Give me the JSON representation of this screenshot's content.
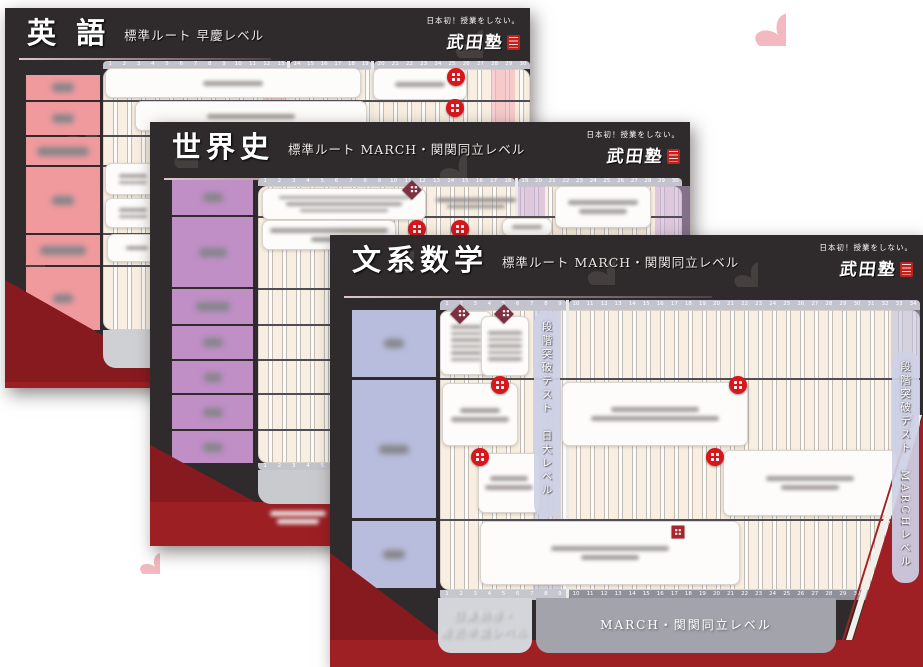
{
  "brand": {
    "tagline": "日本初！授業をしない。",
    "name": "武田塾"
  },
  "page_flowers": [
    [
      130,
      6,
      30
    ],
    [
      752,
      12,
      34
    ],
    [
      3,
      108,
      24
    ],
    [
      5,
      222,
      24
    ],
    [
      138,
      552,
      22
    ]
  ],
  "cards": [
    {
      "id": "english",
      "title": "英 語",
      "subtitle": "標準ルート 早慶レベル",
      "geom": {
        "left": 5,
        "top": 8,
        "width": 525,
        "height": 380
      },
      "colors": {
        "label": "#f09a9e",
        "band": "rgba(244,178,184,0.6)"
      },
      "underline": {
        "y": 50,
        "w": 252
      },
      "flowers": [
        [
          52,
          106,
          40
        ],
        [
          448,
          20,
          30
        ],
        [
          18,
          240,
          22
        ]
      ],
      "labels": {
        "x": 21,
        "y": 67,
        "w": 74,
        "gap": 2,
        "rows": [
          {
            "h": 25,
            "blob": 22
          },
          {
            "h": 33,
            "blob": 22
          },
          {
            "h": 28,
            "blob": 52
          },
          {
            "h": 66,
            "blob": 22
          },
          {
            "h": 30,
            "blob": 46
          },
          {
            "h": 63,
            "blob": 20
          }
        ]
      },
      "grid": {
        "x": 98,
        "y": 53,
        "w": 427,
        "h": 276,
        "strip_h": 8,
        "bottom_strip_h": 7,
        "segments": [
          {
            "x": 98,
            "w": 185,
            "from": 1,
            "to": 13
          },
          {
            "x": 285,
            "w": 82,
            "from": 14,
            "to": 19
          },
          {
            "x": 369,
            "w": 156,
            "from": 20,
            "to": 30
          }
        ],
        "bands": [
          [
            258,
            22
          ],
          [
            486,
            24
          ]
        ],
        "dividers": [
          92,
          127,
          157,
          225,
          257
        ],
        "boxes": [
          {
            "x": 100,
            "y": 60,
            "w": 256,
            "h": 30,
            "lines": [
              60
            ]
          },
          {
            "x": 368,
            "y": 60,
            "w": 94,
            "h": 32,
            "lines": [
              50
            ]
          },
          {
            "x": 130,
            "y": 93,
            "w": 232,
            "h": 30,
            "lines": [
              88
            ]
          },
          {
            "x": 100,
            "y": 155,
            "w": 55,
            "h": 32,
            "small": true,
            "lines": [
              28,
              28
            ]
          },
          {
            "x": 100,
            "y": 190,
            "w": 55,
            "h": 30,
            "small": true,
            "lines": [
              28,
              28
            ]
          },
          {
            "x": 102,
            "y": 226,
            "w": 60,
            "h": 28,
            "small": true,
            "lines": [
              22
            ]
          }
        ],
        "badges": [
          {
            "t": "c",
            "x": 451,
            "y": 69
          },
          {
            "t": "c",
            "x": 450,
            "y": 100
          }
        ]
      },
      "footer": {
        "bars": [
          {
            "x": 98,
            "y": 322,
            "w": 256,
            "h": 38,
            "color": "#cfd0d4",
            "lines": [
              70,
              96
            ]
          }
        ]
      },
      "ribbon": [
        {
          "pts": "0,272 180,374 525,374 525,380 0,380",
          "fill": "#9c1f24"
        },
        {
          "pts": "0,272 180,374 0,374",
          "fill": "#871a1f"
        }
      ]
    },
    {
      "id": "world-history",
      "title": "世界史",
      "subtitle": "標準ルート MARCH・関関同立レベル",
      "geom": {
        "left": 150,
        "top": 122,
        "width": 540,
        "height": 424
      },
      "colors": {
        "label": "#bf8fc5",
        "band": "rgba(200,172,216,0.55)"
      },
      "underline": {
        "y": 56,
        "w": 366
      },
      "flowers": [
        [
          22,
          20,
          26
        ],
        [
          287,
          30,
          30
        ]
      ],
      "labels": {
        "x": 22,
        "y": 58,
        "w": 81,
        "gap": 2,
        "rows": [
          {
            "h": 35,
            "blob": 20
          },
          {
            "h": 70,
            "blob": 28
          },
          {
            "h": 35,
            "blob": 34
          },
          {
            "h": 33,
            "blob": 20
          },
          {
            "h": 32,
            "blob": 18
          },
          {
            "h": 34,
            "blob": 20
          },
          {
            "h": 32,
            "blob": 20
          }
        ]
      },
      "grid": {
        "x": 108,
        "y": 56,
        "w": 424,
        "h": 292,
        "strip_h": 8,
        "bottom_strip_h": 7,
        "segments": [
          {
            "x": 108,
            "w": 257,
            "from": 1,
            "to": 18
          },
          {
            "x": 368,
            "w": 164,
            "from": 19,
            "to": 30
          }
        ],
        "bands": [
          [
            365,
            30
          ],
          [
            505,
            35
          ]
        ],
        "dividers": [
          94,
          166,
          202,
          237,
          271,
          307
        ],
        "boxes": [
          {
            "x": 112,
            "y": 66,
            "w": 164,
            "h": 32,
            "small": true,
            "lines": [
              130,
              116,
              88
            ]
          },
          {
            "x": 280,
            "y": 70,
            "w": 92,
            "h": 22,
            "bare": true,
            "small": true,
            "lines": [
              80,
              58
            ]
          },
          {
            "x": 112,
            "y": 98,
            "w": 134,
            "h": 30,
            "lines": [
              118,
              36
            ]
          },
          {
            "x": 352,
            "y": 96,
            "w": 50,
            "h": 18,
            "small": true,
            "lines": [
              30
            ]
          },
          {
            "x": 405,
            "y": 64,
            "w": 96,
            "h": 42,
            "lines": [
              70,
              48
            ]
          }
        ],
        "badges": [
          {
            "t": "d",
            "x": 262,
            "y": 68
          },
          {
            "t": "c",
            "x": 267,
            "y": 107
          },
          {
            "t": "c",
            "x": 310,
            "y": 107
          }
        ]
      },
      "footer": {
        "bars": [
          {
            "x": 108,
            "y": 348,
            "w": 424,
            "h": 34,
            "color": "#c9cacd"
          },
          {
            "x": 108,
            "y": 384,
            "w": 80,
            "h": 22,
            "lines": [
              56,
              42
            ]
          }
        ]
      },
      "ribbon": [
        {
          "pts": "0,323 105,380 540,380 540,424 0,424",
          "fill": "#9c1f24"
        },
        {
          "pts": "0,323 105,380 0,380",
          "fill": "#871a1f"
        }
      ]
    },
    {
      "id": "liberal-arts-math",
      "title": "文系数学",
      "subtitle": "標準ルート MARCH・関関同立レベル",
      "geom": {
        "left": 330,
        "top": 235,
        "width": 593,
        "height": 432
      },
      "colors": {
        "label": "#b9bddd",
        "band": "rgba(185,188,219,0.55)"
      },
      "underline": {
        "y": 61,
        "w": 368
      },
      "flowers": [
        [
          21,
          85,
          34
        ],
        [
          255,
          20,
          30
        ],
        [
          402,
          26,
          26
        ],
        [
          62,
          14,
          22
        ]
      ],
      "labels": {
        "x": 22,
        "y": 75,
        "w": 84,
        "gap": 3,
        "rows": [
          {
            "h": 67,
            "blob": 20
          },
          {
            "h": 138,
            "blob": 30
          },
          {
            "h": 67,
            "blob": 22
          }
        ]
      },
      "grid": {
        "x": 110,
        "y": 65,
        "w": 480,
        "h": 300,
        "strip_h": 10,
        "bottom_strip_h": 10,
        "segments": [
          {
            "x": 110,
            "w": 127,
            "from": 1,
            "to": 9
          },
          {
            "x": 239,
            "w": 351,
            "from": 10,
            "to": 34
          }
        ],
        "bands": [
          [
            203,
            28
          ],
          [
            561,
            29
          ]
        ],
        "dividers": [
          143,
          284
        ],
        "boxes": [
          {
            "x": 110,
            "y": 76,
            "w": 52,
            "h": 64,
            "small": true,
            "lines": [
              30,
              30,
              30,
              30,
              30,
              30
            ]
          },
          {
            "x": 151,
            "y": 81,
            "w": 48,
            "h": 60,
            "small": true,
            "lines": [
              34,
              34,
              34,
              34,
              34
            ]
          },
          {
            "x": 112,
            "y": 148,
            "w": 76,
            "h": 63,
            "lines": [
              40,
              58
            ]
          },
          {
            "x": 232,
            "y": 147,
            "w": 186,
            "h": 64,
            "lines": [
              88,
              128
            ]
          },
          {
            "x": 393,
            "y": 215,
            "w": 174,
            "h": 66,
            "lines": [
              88,
              58
            ]
          },
          {
            "x": 148,
            "y": 218,
            "w": 62,
            "h": 60,
            "lines": [
              38,
              48
            ]
          },
          {
            "x": 150,
            "y": 286,
            "w": 260,
            "h": 64,
            "lines": [
              118,
              58
            ]
          }
        ],
        "badges": [
          {
            "t": "d",
            "x": 130,
            "y": 79
          },
          {
            "t": "d",
            "x": 174,
            "y": 79
          },
          {
            "t": "c",
            "x": 170,
            "y": 150
          },
          {
            "t": "c",
            "x": 408,
            "y": 150
          },
          {
            "t": "c",
            "x": 385,
            "y": 222
          },
          {
            "t": "c",
            "x": 150,
            "y": 222
          },
          {
            "t": "s",
            "x": 348,
            "y": 297
          }
        ]
      },
      "strip_colors": {
        "top": "#c3c3ce",
        "bottom": [
          "#c6c6cf",
          "#90909a"
        ]
      },
      "vstrips": [
        {
          "x": 204,
          "y": 76,
          "w": 26,
          "h": 206,
          "texts": [
            "段階突破テスト",
            "日大レベル"
          ]
        },
        {
          "x": 562,
          "y": 116,
          "w": 27,
          "h": 232,
          "texts": [
            "段階突破テスト",
            "MARCHレベル"
          ]
        }
      ],
      "footer": {
        "bars": [
          {
            "x": 108,
            "y": 363,
            "w": 94,
            "h": 55,
            "color": "#d4d5da",
            "texts": [
              "日東駒専・",
              "産近甲龍レベル"
            ]
          },
          {
            "x": 206,
            "y": 363,
            "w": 300,
            "h": 55,
            "color": "#a2a3ab",
            "text": "MARCH・関関同立レベル"
          }
        ]
      },
      "ribbon": [
        {
          "pts": "0,318 115,405 523,405 593,180 593,432 0,432",
          "fill": "#9e2025"
        },
        {
          "pts": "0,318 115,405 0,405",
          "fill": "#871a1f"
        },
        {
          "pts": "522,405 592,180 586,180 516,405",
          "fill": "#f2efe9"
        },
        {
          "pts": "514,405 584,180 582,180 512,405",
          "fill": "#a32227"
        }
      ]
    }
  ]
}
